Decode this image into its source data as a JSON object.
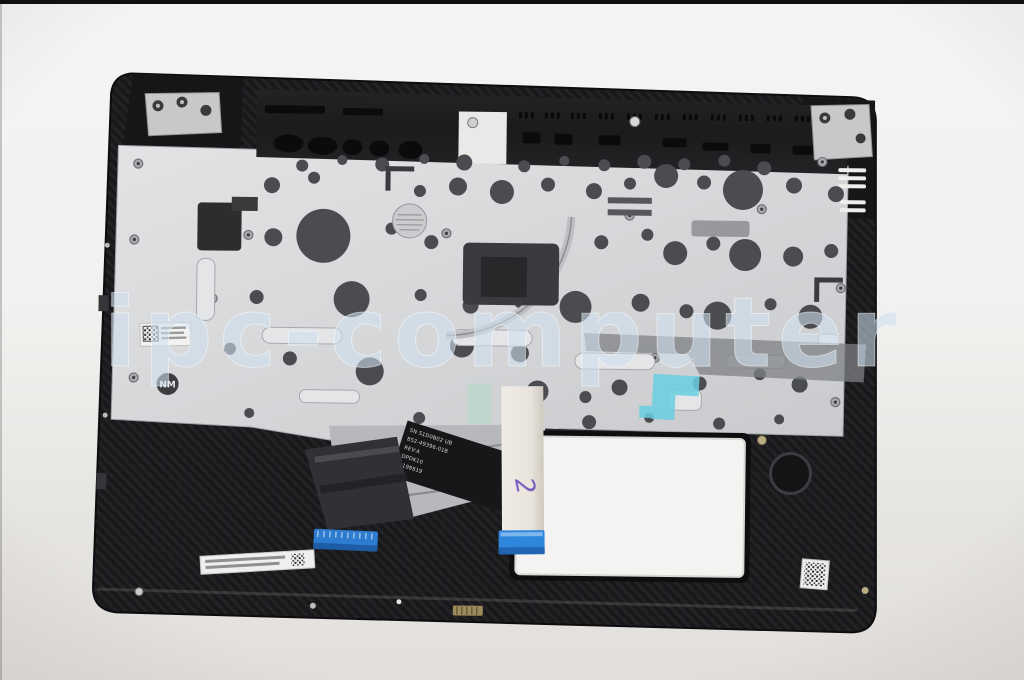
{
  "photo": {
    "description": "laptop palmrest keyboard-bezel spare part, underside product photo",
    "watermark_text": "ipc-computer",
    "part": {
      "flex_label_lines": [
        "SN S1D0B02 UB",
        "8S2-49396-01B",
        "REV:A",
        "DPDK10",
        "E198819"
      ],
      "nm_stamp": "NM",
      "ribbon_handwriting": "2"
    },
    "colors": {
      "background_top": "#f5f4f3",
      "background_bottom": "#e2dfdc",
      "case_black": "#1c1c1e",
      "plate_silver": "#d6d7d9",
      "dome_hole_gray": "#4a4c50",
      "connector_blue": "#2f86dd",
      "tape_cyan": "#69cfe2",
      "ribbon_cream": "#e9e5dd",
      "watermark_blue": "#cfe0ef",
      "handwriting_purple": "#7b5fc0"
    }
  }
}
